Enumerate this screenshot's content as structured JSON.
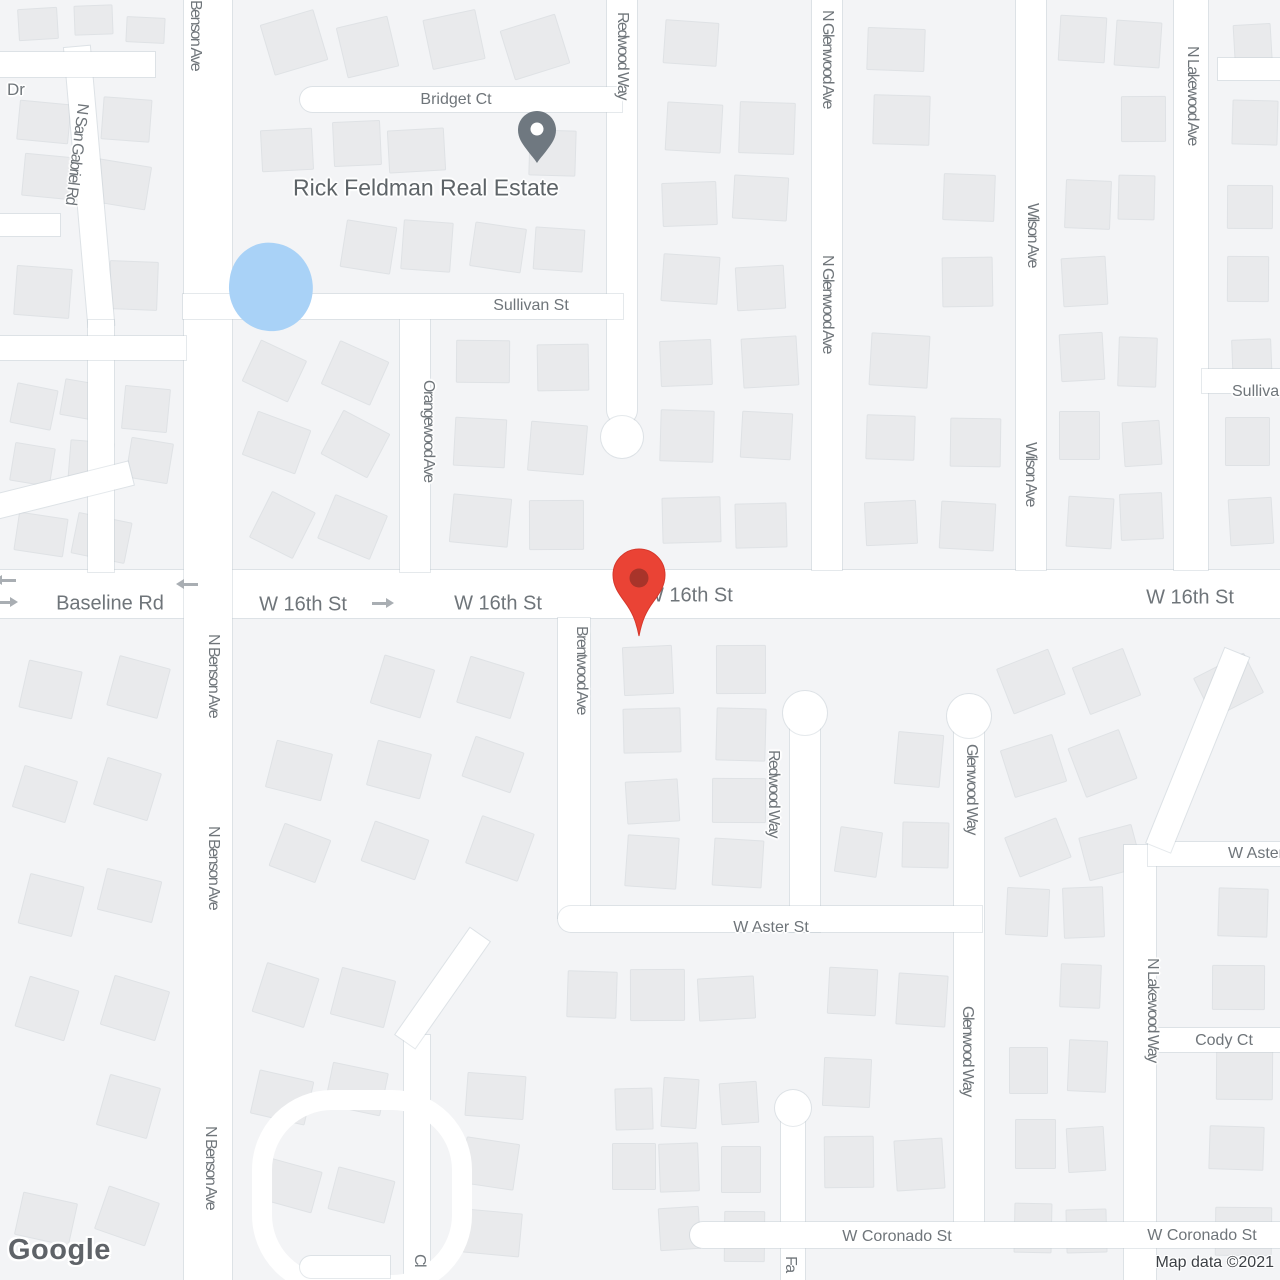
{
  "logo": {
    "text": "Google"
  },
  "attribution": {
    "text": "Map data ©2021"
  },
  "poi": {
    "label": "Rick Feldman Real Estate"
  },
  "colors": {
    "destination_pin": "#EA4335",
    "destination_pin_inner": "#A8342A",
    "poi_pin": "#6F7880",
    "water": "#A9D2F7",
    "road": "#FFFFFF",
    "road_label": "#6F757A",
    "attribution_text": "#3C4045"
  },
  "street_labels_horizontal": [
    {
      "text": "Dr",
      "x": 16,
      "y": 90,
      "size": 17
    },
    {
      "text": "Bridget Ct",
      "x": 456,
      "y": 100,
      "size": 16
    },
    {
      "text": "Sullivan St",
      "x": 531,
      "y": 306,
      "size": 16
    },
    {
      "text": "Sullivan St",
      "x": 1232,
      "y": 392,
      "size": 16,
      "anchor": "left"
    },
    {
      "text": "Baseline Rd",
      "x": 110,
      "y": 604,
      "size": 20
    },
    {
      "text": "W 16th St",
      "x": 303,
      "y": 605,
      "size": 20
    },
    {
      "text": "W 16th St",
      "x": 498,
      "y": 604,
      "size": 20
    },
    {
      "text": "W 16th St",
      "x": 645,
      "y": 596,
      "size": 20,
      "anchor": "left"
    },
    {
      "text": "W 16th St",
      "x": 1190,
      "y": 598,
      "size": 20
    },
    {
      "text": "W Aster St",
      "x": 771,
      "y": 928,
      "size": 16
    },
    {
      "text": "W Aster St",
      "x": 1228,
      "y": 854,
      "size": 16,
      "anchor": "left"
    },
    {
      "text": "Cody Ct",
      "x": 1224,
      "y": 1041,
      "size": 16
    },
    {
      "text": "W Coronado St",
      "x": 897,
      "y": 1237,
      "size": 16
    },
    {
      "text": "W Coronado St",
      "x": 1202,
      "y": 1236,
      "size": 16
    }
  ],
  "street_labels_vertical": [
    {
      "text": "Benson Ave",
      "x": 195,
      "y": 0,
      "size": 16
    },
    {
      "text": "N San Gabriel Rd",
      "x": 76,
      "y": 103,
      "size": 16,
      "rot": 7
    },
    {
      "text": "Redwood Way",
      "x": 622,
      "y": 12,
      "size": 16
    },
    {
      "text": "N Glenwood Ave",
      "x": 827,
      "y": 10,
      "size": 16
    },
    {
      "text": "N Glenwood Ave",
      "x": 827,
      "y": 255,
      "size": 16
    },
    {
      "text": "Wilson Ave",
      "x": 1032,
      "y": 203,
      "size": 16
    },
    {
      "text": "Wilson Ave",
      "x": 1030,
      "y": 442,
      "size": 16
    },
    {
      "text": "N Lakewood Ave",
      "x": 1192,
      "y": 46,
      "size": 16
    },
    {
      "text": "Orangewood Ave",
      "x": 428,
      "y": 380,
      "size": 16
    },
    {
      "text": "N Benson Ave",
      "x": 213,
      "y": 634,
      "size": 16
    },
    {
      "text": "N Benson Ave",
      "x": 213,
      "y": 826,
      "size": 16
    },
    {
      "text": "N Benson Ave",
      "x": 210,
      "y": 1126,
      "size": 16
    },
    {
      "text": "Brentwood Ave",
      "x": 581,
      "y": 626,
      "size": 16
    },
    {
      "text": "Redwood Way",
      "x": 773,
      "y": 750,
      "size": 16
    },
    {
      "text": "Glenwood Way",
      "x": 971,
      "y": 744,
      "size": 16
    },
    {
      "text": "Glenwood Way",
      "x": 967,
      "y": 1006,
      "size": 16
    },
    {
      "text": "N Lakewood Way",
      "x": 1152,
      "y": 958,
      "size": 16
    },
    {
      "text": "Fa",
      "x": 790,
      "y": 1256,
      "size": 16
    },
    {
      "text": "Cl",
      "x": 419,
      "y": 1254,
      "size": 16
    }
  ],
  "arrows": [
    {
      "dir": "left",
      "x": 2,
      "y": 579
    },
    {
      "dir": "right",
      "x": -4,
      "y": 601
    },
    {
      "dir": "left",
      "x": 184,
      "y": 583
    },
    {
      "dir": "right",
      "x": 372,
      "y": 602
    }
  ]
}
